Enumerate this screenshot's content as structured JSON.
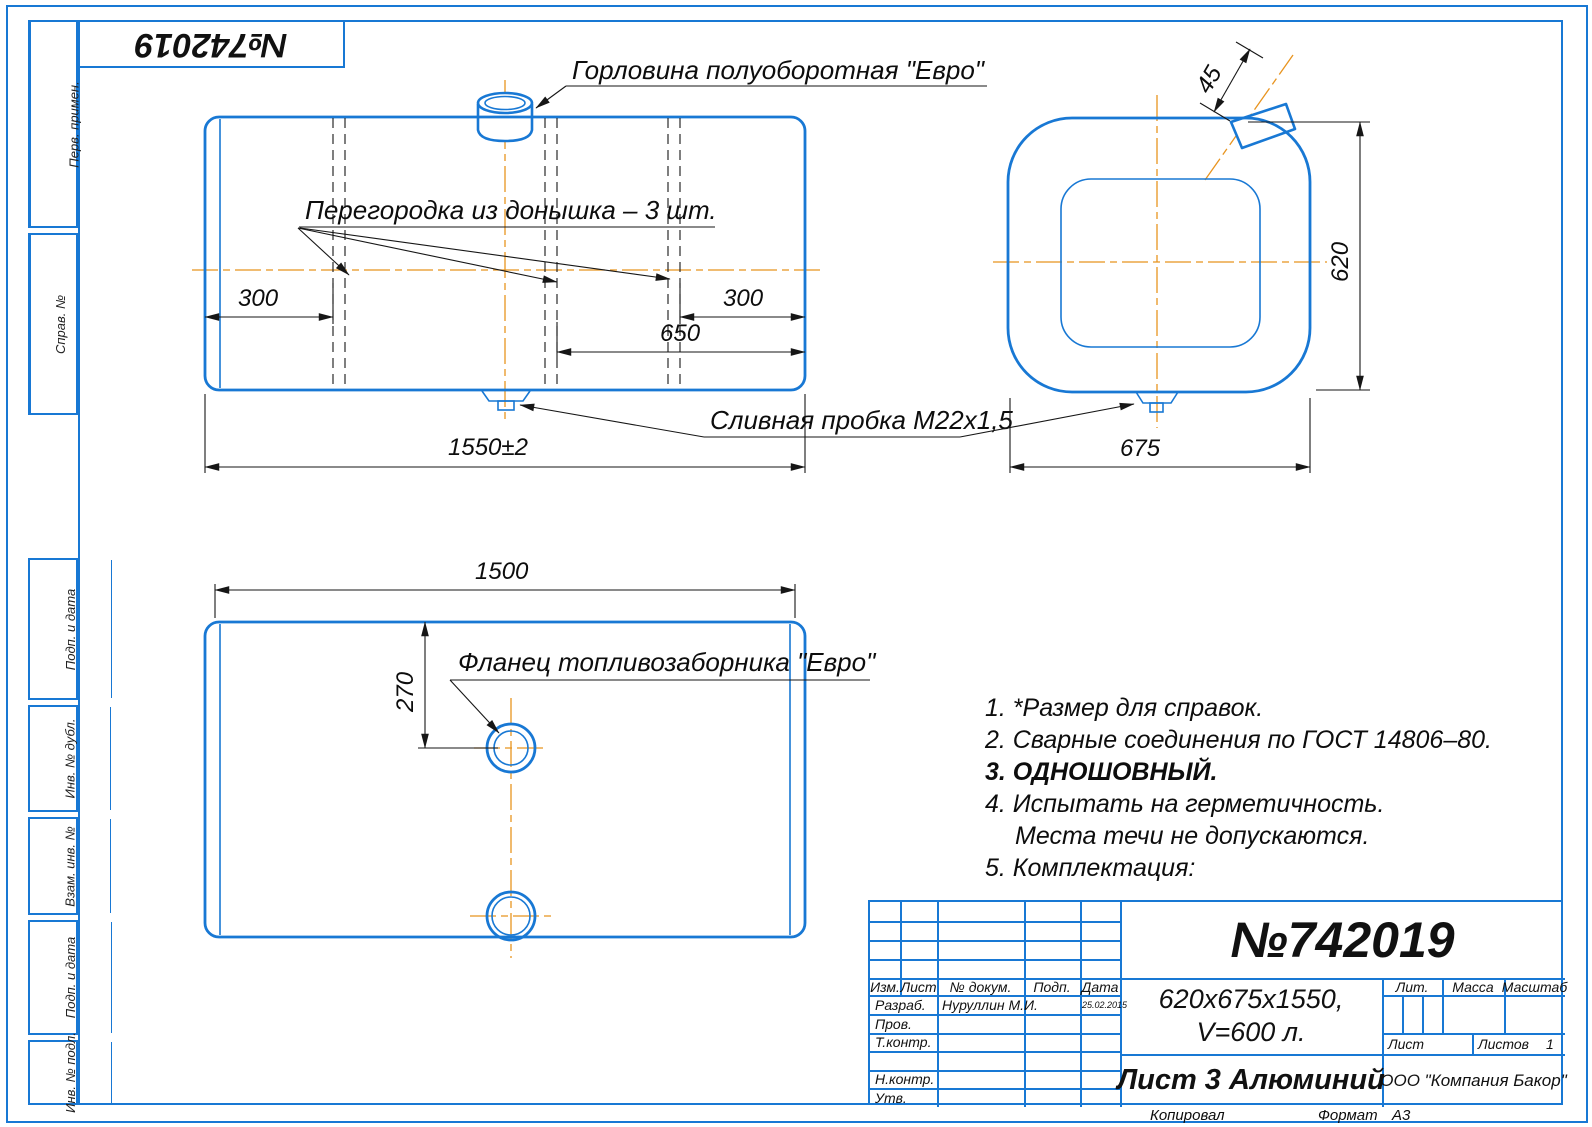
{
  "page": {
    "stamp_number": "№742019",
    "copied_label": "Копировал",
    "format_label": "Формат",
    "format_value": "А3"
  },
  "margin_labels": {
    "perv_primen": "Перв. примен.",
    "sprav_no": "Справ. №",
    "podp_data_1": "Подп. и дата",
    "inv_dubl": "Инв. № дубл.",
    "vzam_inv": "Взам. инв. №",
    "podp_data_2": "Подп. и дата",
    "inv_podl": "Инв. № подл."
  },
  "views": {
    "front": {
      "neck_label": "Горловина полуоборотная \"Евро\"",
      "baffle_label": "Перегородка из донышка – 3 шт.",
      "drain_label": "Сливная пробка М22х1,5",
      "dim_left": "300",
      "dim_right": "300",
      "dim_650": "650",
      "dim_length": "1550±2"
    },
    "side": {
      "dim_height": "620",
      "dim_width": "675",
      "dim_neck": "45"
    },
    "bottom": {
      "flange_label": "Фланец топливозаборника \"Евро\"",
      "dim_1500": "1500",
      "dim_270": "270"
    }
  },
  "notes": {
    "n1": "1. *Размер для справок.",
    "n2": "2. Сварные соединения по ГОСТ 14806–80.",
    "n3": "3. ОДНОШОВНЫЙ.",
    "n4a": "4. Испытать на герметичность.",
    "n4b": "Места течи не допускаются.",
    "n5": "5. Комплектация:"
  },
  "title_block": {
    "doc_number": "№742019",
    "size_line1": "620х675х1550,",
    "size_line2": "V=600 л.",
    "material": "Лист 3 Алюминий",
    "company": "ООО \"Компания Бакор\"",
    "header_izm": "Изм.",
    "header_list": "Лист",
    "header_dokum": "№ докум.",
    "header_podp": "Подп.",
    "header_data": "Дата",
    "row_razrab": "Разраб.",
    "razrab_name": "Нуруллин М.И.",
    "razrab_date": "25.02.2015",
    "row_prov": "Пров.",
    "row_tkontr": "Т.контр.",
    "row_nkontr": "Н.контр.",
    "row_utv": "Утв.",
    "lit_label": "Лит.",
    "massa_label": "Масса",
    "masshtab_label": "Масштаб",
    "list_label": "Лист",
    "listov_label": "Листов",
    "listov_value": "1"
  }
}
